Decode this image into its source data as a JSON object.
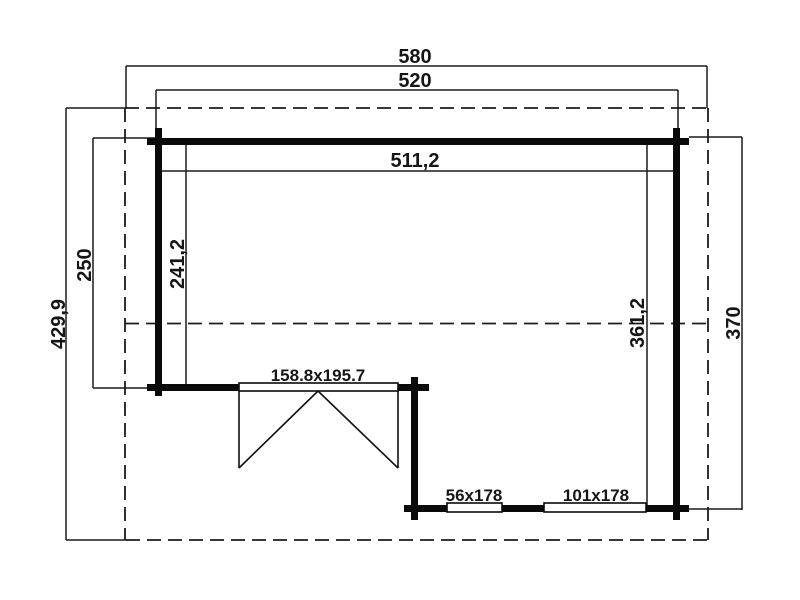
{
  "drawing": {
    "kind": "log-cabin-floor-plan",
    "background_color": "#ffffff",
    "line_color": "#1c1c1c",
    "wall_color": "#0a0a0a",
    "dimensions": {
      "roof_width": "580",
      "exterior_width": "520",
      "interior_width": "511,2",
      "roof_depth": "429,9",
      "front_section_depth": "250",
      "interior_front_depth": "241,2",
      "interior_main_depth": "361,2",
      "exterior_depth": "370"
    },
    "openings": {
      "double_door": "158.8x195.7",
      "window_small": "56x178",
      "window_large": "101x178"
    }
  }
}
